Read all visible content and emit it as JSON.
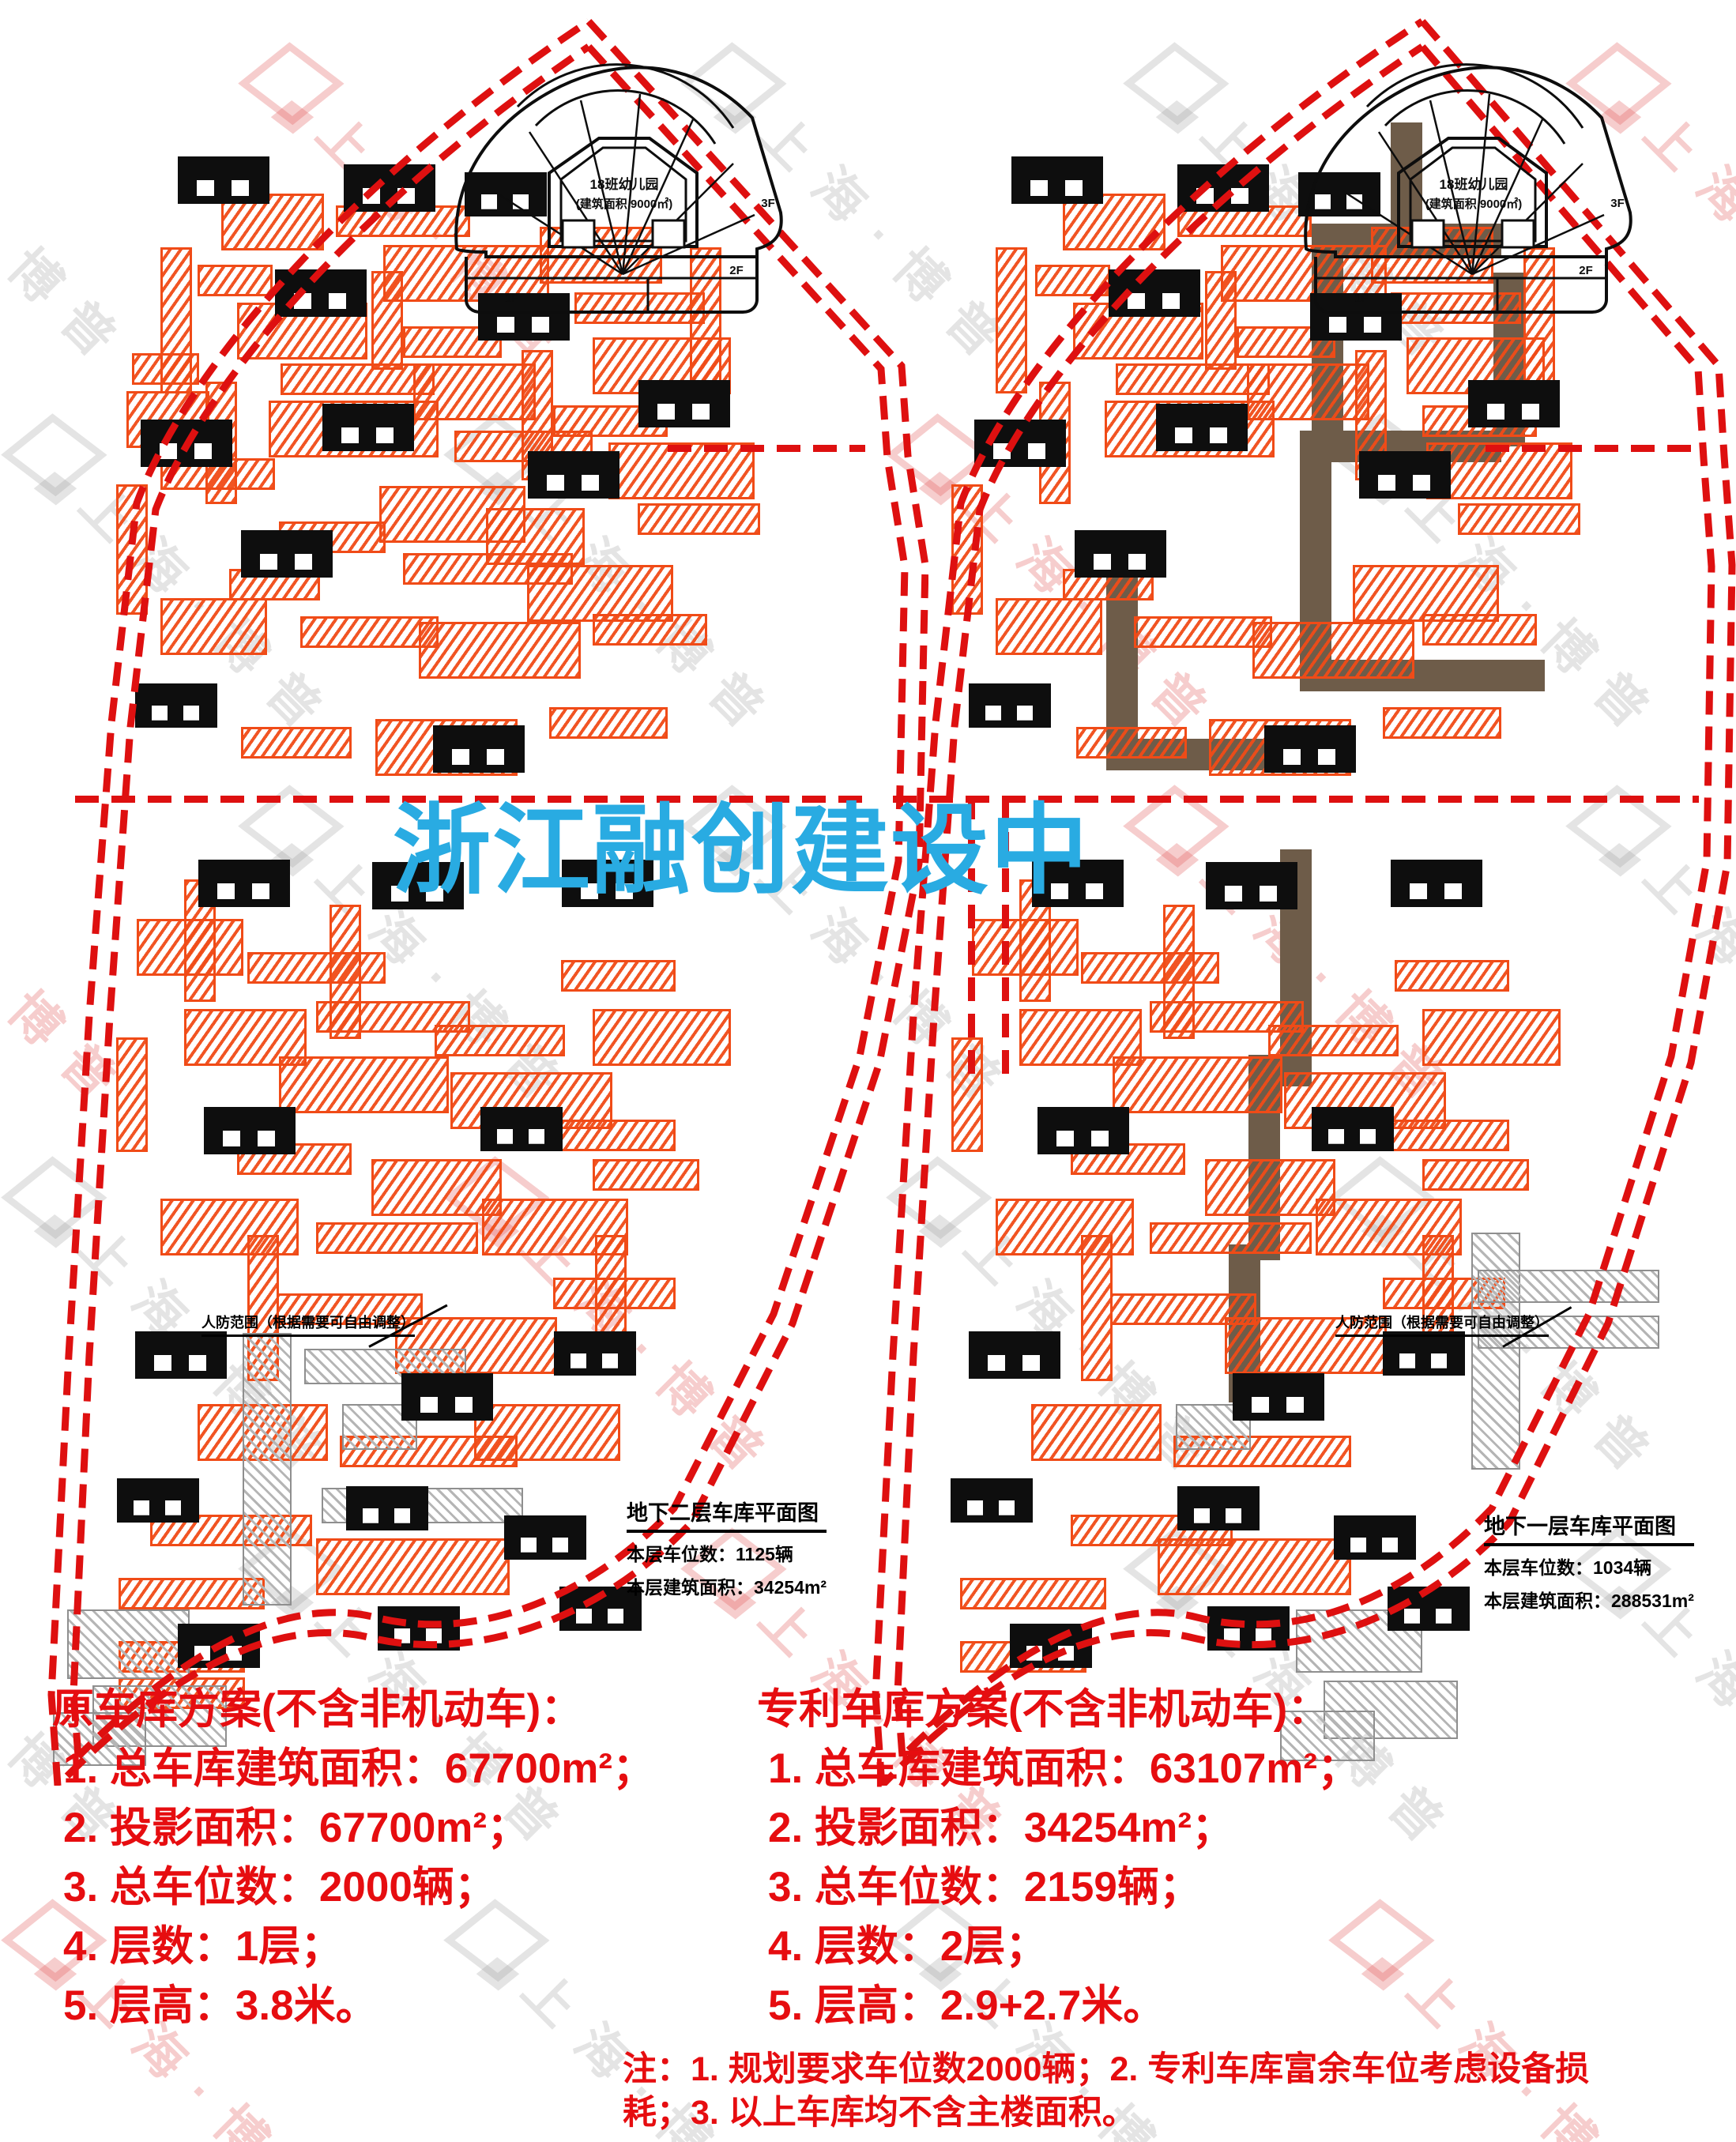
{
  "colors": {
    "red_text": "#e60d10",
    "boundary_red": "#de1010",
    "stall_orange": "#f04b17",
    "corridor_brown": "#6e5c49",
    "overlay_blue": "#29abe2",
    "hatch_gray": "#b5b5b5",
    "building_black": "#0e0e0e"
  },
  "watermark": {
    "text": "上海·博普"
  },
  "overlay_title": "浙江融创建设中",
  "plans": [
    {
      "side": "left",
      "building_label_line1": "18班幼儿园",
      "building_label_line2": "(建筑面积 9000㎡)",
      "floor_label_1": "1F",
      "floor_label_2": "2F",
      "floor_label_3": "3F",
      "annotation": "人防范围（根据需要可自由调整）",
      "info_box": {
        "title": "地下二层车库平面图",
        "line1": "本层车位数：1125辆",
        "line2": "本层建筑面积：34254m²"
      }
    },
    {
      "side": "right",
      "building_label_line1": "18班幼儿园",
      "building_label_line2": "(建筑面积 9000㎡)",
      "floor_label_1": "1F",
      "floor_label_2": "2F",
      "floor_label_3": "3F",
      "annotation": "人防范围（根据需要可自由调整）",
      "info_box": {
        "title": "地下一层车库平面图",
        "line1": "本层车位数：1034辆",
        "line2": "本层建筑面积：288531m²"
      }
    }
  ],
  "summary_left": {
    "header": "原车库方案(不含非机动车)：",
    "items": [
      "1. 总车库建筑面积：67700m²；",
      "2. 投影面积：67700m²；",
      "3. 总车位数：2000辆；",
      "4. 层数：1层；",
      "5. 层高：3.8米。"
    ]
  },
  "summary_right": {
    "header": "专利车库方案(不含非机动车)：",
    "items": [
      "1. 总车库建筑面积：63107m²；",
      "2. 投影面积：34254m²；",
      "3. 总车位数：2159辆；",
      "4. 层数：2层；",
      "5. 层高：2.9+2.7米。"
    ]
  },
  "note": {
    "line1": "注：1. 规划要求车位数2000辆；2. 专利车库富余车位考虑设备损",
    "line2": "耗；3. 以上车库均不含主楼面积。"
  }
}
